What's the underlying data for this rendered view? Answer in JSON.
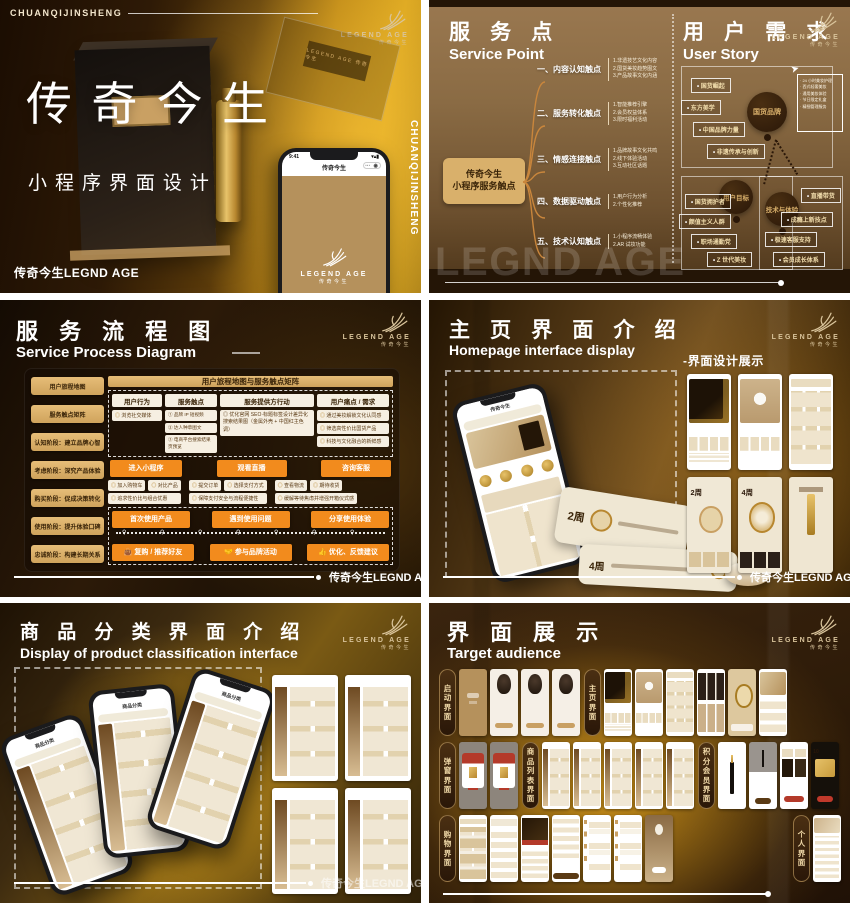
{
  "colors": {
    "accent_orange": "#f28b1d",
    "gold": "#d9b06b",
    "dark_brown": "#2a1708",
    "cream": "#f3ecdd",
    "red": "#c0392b"
  },
  "brand": {
    "logo_text": "LEGEND AGE",
    "logo_sub": "传奇今生",
    "footer_brand": "传奇今生LEGND AGE",
    "watermark": "LEGND AGE"
  },
  "cover": {
    "kicker": "CHUANQIJINSHENG",
    "title": "传奇今生",
    "subtitle": "小程序界面设计",
    "footer": "传奇今生LEGND AGE",
    "side_text": "CHUANQIJINSHENG",
    "box_label": "LEGEND AGE 传奇今生",
    "phone": {
      "time": "9:41",
      "app_title": "传奇今生",
      "capsule": "⋯ ◉",
      "logo_text": "LEGEND AGE",
      "logo_sub": "传奇今生"
    }
  },
  "service_point": {
    "title_cn": "服 务 点",
    "title_en": "Service Point",
    "story_title_cn": "用 户 需 求",
    "story_title_en": "User Story",
    "center_node_line1": "传奇今生",
    "center_node_line2": "小程序服务触点",
    "branches": [
      {
        "label": "一、内容认知触点",
        "subs": [
          "1.非遗技艺文化内容",
          "2.国货美妆趋势图文",
          "3.产品故事文化内涵"
        ]
      },
      {
        "label": "二、服务转化触点",
        "subs": [
          "1.智能推荐引擎",
          "2.会员权益体系",
          "3.限时福利活动"
        ]
      },
      {
        "label": "三、情感连接触点",
        "subs": [
          "1.品牌故事文化共鸣",
          "2.线下体验活动",
          "3.互动社区话题"
        ]
      },
      {
        "label": "四、数据驱动触点",
        "subs": [
          "1.用户行为分析",
          "2.个性化推荐"
        ]
      },
      {
        "label": "五、技术认知触点",
        "subs": [
          "1.小程序流畅体验",
          "2.AR 试妆功能"
        ]
      }
    ],
    "story_groups": [
      {
        "bubble": "国货品牌",
        "tags": [
          "国货崛起",
          "东方美学",
          "中国品牌力量",
          "非遗传承与创新"
        ]
      },
      {
        "bubble": "用户目标",
        "tags": [
          "国货拥护者",
          "颜值主义人群",
          "职场通勤党",
          "Z 世代美妆"
        ]
      },
      {
        "bubble": "技术与体验",
        "tags": [
          "直播带货",
          "成瘾上新技点",
          "极速客服支持",
          "会员成长体系"
        ]
      }
    ],
    "note_items": [
      "24 小时美妆护理",
      "西式轻奢美妆",
      "通用美妆体验",
      "节日限定礼盒",
      "精细管理服务"
    ]
  },
  "process": {
    "title_cn": "服 务 流 程 图",
    "title_en": "Service Process Diagram",
    "stages": [
      "用户旅程地图",
      "服务触点矩阵",
      "认知阶段：建立品牌心智",
      "考虑阶段：深究产品体验",
      "购买阶段：促成决策转化",
      "使用阶段：提升体验口碑",
      "忠诚阶段：构建长期关系"
    ],
    "matrix_title": "用户旅程地图与服务触点矩阵",
    "headers": [
      "用户行为",
      "服务触点",
      "服务提供方行动",
      "用户痛点 / 需求"
    ],
    "awareness": {
      "behavior": "浏览社交媒体",
      "touchpoints": [
        "① 品牌 IP 短视频",
        "② 达人种草图文",
        "③ 电商平台搜索结果页预览"
      ],
      "provider": "优化官网 SEO·标题标签设计差异化搜索结果图（金属外壳 + 中国红主色调）",
      "needs": [
        "通过美妆解锁文化认同感",
        "筛选高性价比国货产品",
        "科技与文化融合的新鲜感"
      ]
    },
    "consider_actions": [
      "进入小程序",
      "观看直播",
      "咨询客服"
    ],
    "purchase_groups": [
      {
        "tags": [
          "加入购物车",
          "对比产品"
        ],
        "note": "追求性价比与组合优惠"
      },
      {
        "tags": [
          "提交订单",
          "选择支付方式"
        ],
        "note": "保障支付安全与流程便捷性"
      },
      {
        "tags": [
          "查看物流",
          "期待收货"
        ],
        "note": "缓解等待焦虑并增强开箱仪式感"
      }
    ],
    "use_actions": [
      "首次使用产品",
      "遇到使用问题",
      "分享使用体验"
    ],
    "loyalty_actions": [
      "复购 / 推荐好友",
      "参与品牌活动",
      "优化、反馈建议"
    ]
  },
  "homepage": {
    "title_cn": "主 页 界 面 介 绍",
    "title_en": "Homepage interface display",
    "badge": "-界面设计展示",
    "phone_title": "传奇今生",
    "scroll_tag_1": "2周",
    "scroll_tag_2": "4周",
    "screens": [
      "hero-dark",
      "hero-jar",
      "grid",
      "banner2w",
      "banner4w",
      "detail-cream"
    ]
  },
  "classification": {
    "title_cn": "商 品 分 类 界 面 介 绍",
    "title_en": "Display of product classification interface",
    "phone_title": "商品分类",
    "thumbs": [
      "category",
      "category",
      "category",
      "category"
    ]
  },
  "gallery": {
    "title_cn": "界 面 展 示",
    "title_en": "Target audience",
    "screen_texts": {
      "banner2w": "2周",
      "banner4w": "4周",
      "coupon-dark": "10"
    },
    "rows": [
      [
        {
          "pill": "启动界面",
          "screens": [
            "splash",
            "face",
            "face",
            "face"
          ]
        },
        {
          "pill": "主页界面",
          "screens": [
            "hero-dark",
            "hero-jar",
            "grid",
            "faces",
            "ring",
            "hero-tan"
          ]
        }
      ],
      [
        {
          "pill": "弹窗界面",
          "screens": [
            "popup-red",
            "popup-red"
          ]
        },
        {
          "pill": "商品列表界面",
          "screens": [
            "category",
            "category",
            "category",
            "category",
            "category"
          ]
        },
        {
          "pill": "积分会员界面",
          "screens": [
            "member-lipstick",
            "member-dark",
            "coupon-white",
            "coupon-dark"
          ]
        }
      ],
      [
        {
          "pill": "购物界面",
          "screens": [
            "feed",
            "list",
            "promo-dark",
            "checkout",
            "cart",
            "cart",
            "confirm"
          ]
        },
        {
          "pill": "个人界面",
          "screens": [
            "profile"
          ]
        }
      ]
    ]
  }
}
